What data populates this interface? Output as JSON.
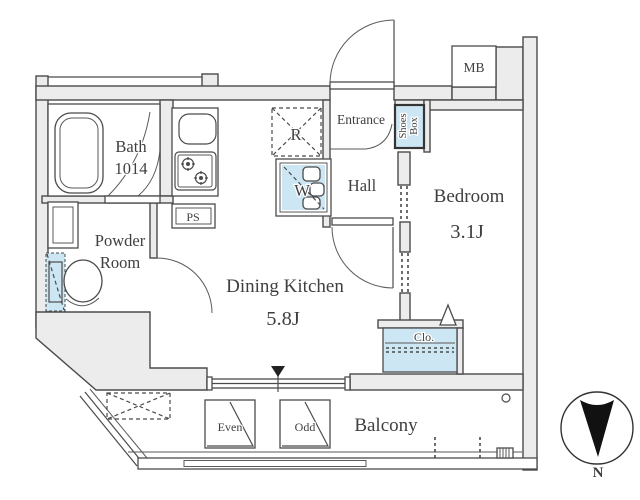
{
  "colors": {
    "wall_fill": "#ececec",
    "line": "#4b4b4b",
    "accent_blue": "#cde6f3",
    "text": "#3f3f3f",
    "needle": "#111111"
  },
  "rooms": {
    "dining_kitchen": {
      "name": "Dining Kitchen",
      "size": "5.8J"
    },
    "bedroom": {
      "name": "Bedroom",
      "size": "3.1J"
    },
    "bath": {
      "name": "Bath",
      "size": "1014"
    },
    "powder": {
      "line1": "Powder",
      "line2": "Room"
    },
    "entrance": {
      "name": "Entrance"
    },
    "hall": {
      "name": "Hall"
    },
    "balcony": {
      "name": "Balcony"
    }
  },
  "fixtures": {
    "ps": "PS",
    "mb": "MB",
    "fridge": "R",
    "washer": "W",
    "shoes_box": {
      "line1": "Shoes",
      "line2": "Box"
    },
    "closet": "Clo.",
    "hatch_even": "Even",
    "hatch_odd": "Odd"
  },
  "compass": {
    "north": "N"
  }
}
